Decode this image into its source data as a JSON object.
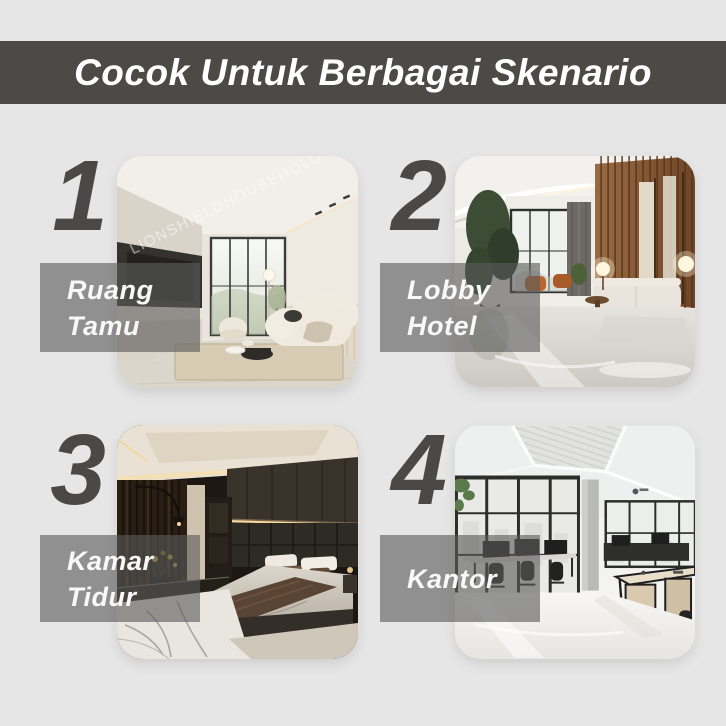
{
  "header": {
    "title": "Cocok Untuk Berbagai Skenario"
  },
  "watermark": {
    "text": "LIONSHIELDHOUSEHOLD"
  },
  "scenarios": [
    {
      "number": "1",
      "label": {
        "line1": "Ruang",
        "line2": "Tamu"
      },
      "photo_name": "living-room"
    },
    {
      "number": "2",
      "label": {
        "line1": "Lobby",
        "line2": "Hotel"
      },
      "photo_name": "hotel-lobby"
    },
    {
      "number": "3",
      "label": {
        "line1": "Kamar",
        "line2": "Tidur"
      },
      "photo_name": "bedroom"
    },
    {
      "number": "4",
      "label": {
        "line1": "Kantor",
        "line2": ""
      },
      "photo_name": "office"
    }
  ],
  "colors": {
    "background": "#e6e6e6",
    "header_band": "#4b4a46",
    "header_text": "#ffffff",
    "numeral": "#4a4947",
    "label_box": "rgba(90,90,90,0.62)",
    "label_text": "#f8f8f8",
    "watermark_text": "rgba(255,255,255,0.52)"
  }
}
